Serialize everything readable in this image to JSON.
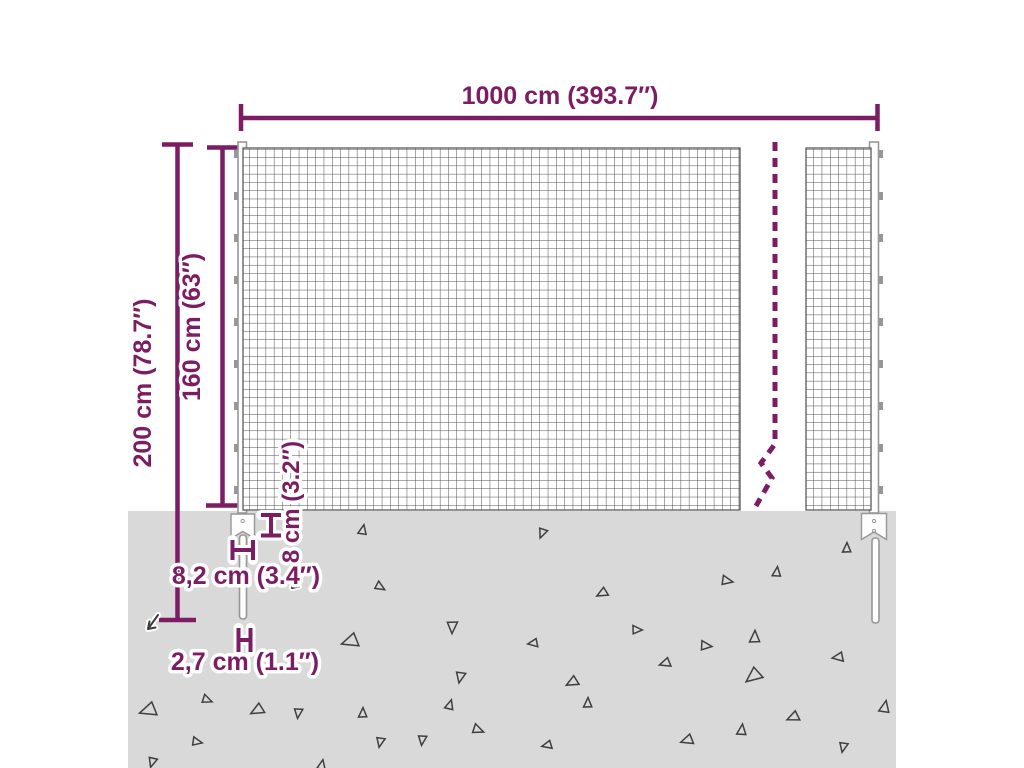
{
  "diagram": {
    "type": "product-dimension-diagram",
    "subject": "wire-mesh-fence-with-ground-spikes",
    "dimensions": {
      "total_width": {
        "label": "1000 cm (393.7″)"
      },
      "total_height": {
        "label": "200 cm (78.7″)"
      },
      "mesh_height": {
        "label": "160 cm (63″)"
      },
      "anchor_height": {
        "label": "8 cm (3.2″)"
      },
      "anchor_width": {
        "label": "8,2 cm (3.4″)"
      },
      "spike_width": {
        "label": "2,7 cm (1.1″)"
      }
    },
    "colors": {
      "dimension_accent": "#7c1d64",
      "ground": "#d9d9da",
      "mesh_line": "#4e4e4e",
      "post_outline": "#979797",
      "triangle_outline": "#3f3f3f"
    },
    "ground": {
      "triangles": [
        [
          363,
          530,
          10,
          0.9
        ],
        [
          542,
          533,
          200,
          0.9
        ],
        [
          380,
          587,
          120,
          0.9
        ],
        [
          350,
          641,
          250,
          1.5
        ],
        [
          452,
          627,
          180,
          1.1
        ],
        [
          533,
          643,
          260,
          0.9
        ],
        [
          460,
          677,
          190,
          1.0
        ],
        [
          847,
          548,
          0,
          0.9
        ],
        [
          777,
          572,
          5,
          0.9
        ],
        [
          727,
          581,
          100,
          1.0
        ],
        [
          602,
          593,
          240,
          1.0
        ],
        [
          637,
          630,
          90,
          0.9
        ],
        [
          755,
          637,
          0,
          1.1
        ],
        [
          706,
          646,
          95,
          1.0
        ],
        [
          665,
          663,
          250,
          1.0
        ],
        [
          838,
          657,
          260,
          1.0
        ],
        [
          753,
          676,
          230,
          1.5
        ],
        [
          572,
          682,
          240,
          1.1
        ],
        [
          148,
          710,
          250,
          1.5
        ],
        [
          207,
          700,
          110,
          0.9
        ],
        [
          257,
          710,
          240,
          1.2
        ],
        [
          298,
          713,
          185,
          0.9
        ],
        [
          363,
          713,
          0,
          0.9
        ],
        [
          380,
          742,
          190,
          0.9
        ],
        [
          197,
          742,
          100,
          0.9
        ],
        [
          152,
          762,
          195,
          0.9
        ],
        [
          322,
          765,
          10,
          0.9
        ],
        [
          450,
          705,
          15,
          0.9
        ],
        [
          478,
          730,
          110,
          1.0
        ],
        [
          422,
          740,
          185,
          0.9
        ],
        [
          547,
          745,
          255,
          0.9
        ],
        [
          588,
          703,
          0,
          0.9
        ],
        [
          687,
          740,
          250,
          1.1
        ],
        [
          742,
          730,
          5,
          1.0
        ],
        [
          793,
          717,
          245,
          1.1
        ],
        [
          843,
          747,
          190,
          0.9
        ],
        [
          885,
          707,
          10,
          1.1
        ]
      ]
    }
  }
}
